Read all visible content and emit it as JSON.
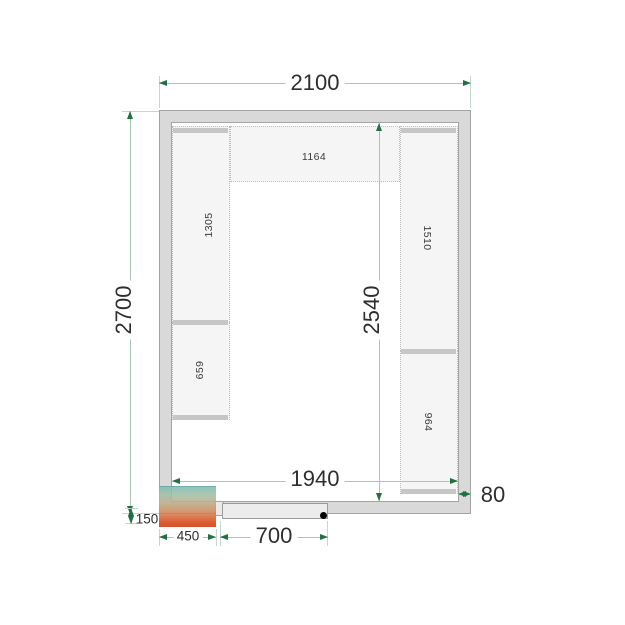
{
  "dimensions": {
    "outer_width": "2100",
    "outer_height": "2700",
    "interior_width": "1940",
    "interior_height": "2540",
    "wall_thickness": "80",
    "unit_width": "450",
    "unit_offset": "150",
    "door_width": "700"
  },
  "shelves": {
    "top": "1164",
    "left_upper": "1305",
    "left_lower": "659",
    "right_upper": "1510",
    "right_lower": "964"
  },
  "colors": {
    "dimension_line": "#a5c7b4",
    "dimension_arrow": "#207140",
    "wall_fill": "#d9d9d9",
    "wall_outline": "#a3a3a3",
    "shelf_fill": "#f5f5f5",
    "shelf_edge_strip": "#c6c6c6",
    "unit_cold": "#7ebcb6",
    "unit_hot": "#d84114",
    "door_pivot": "#000000"
  }
}
